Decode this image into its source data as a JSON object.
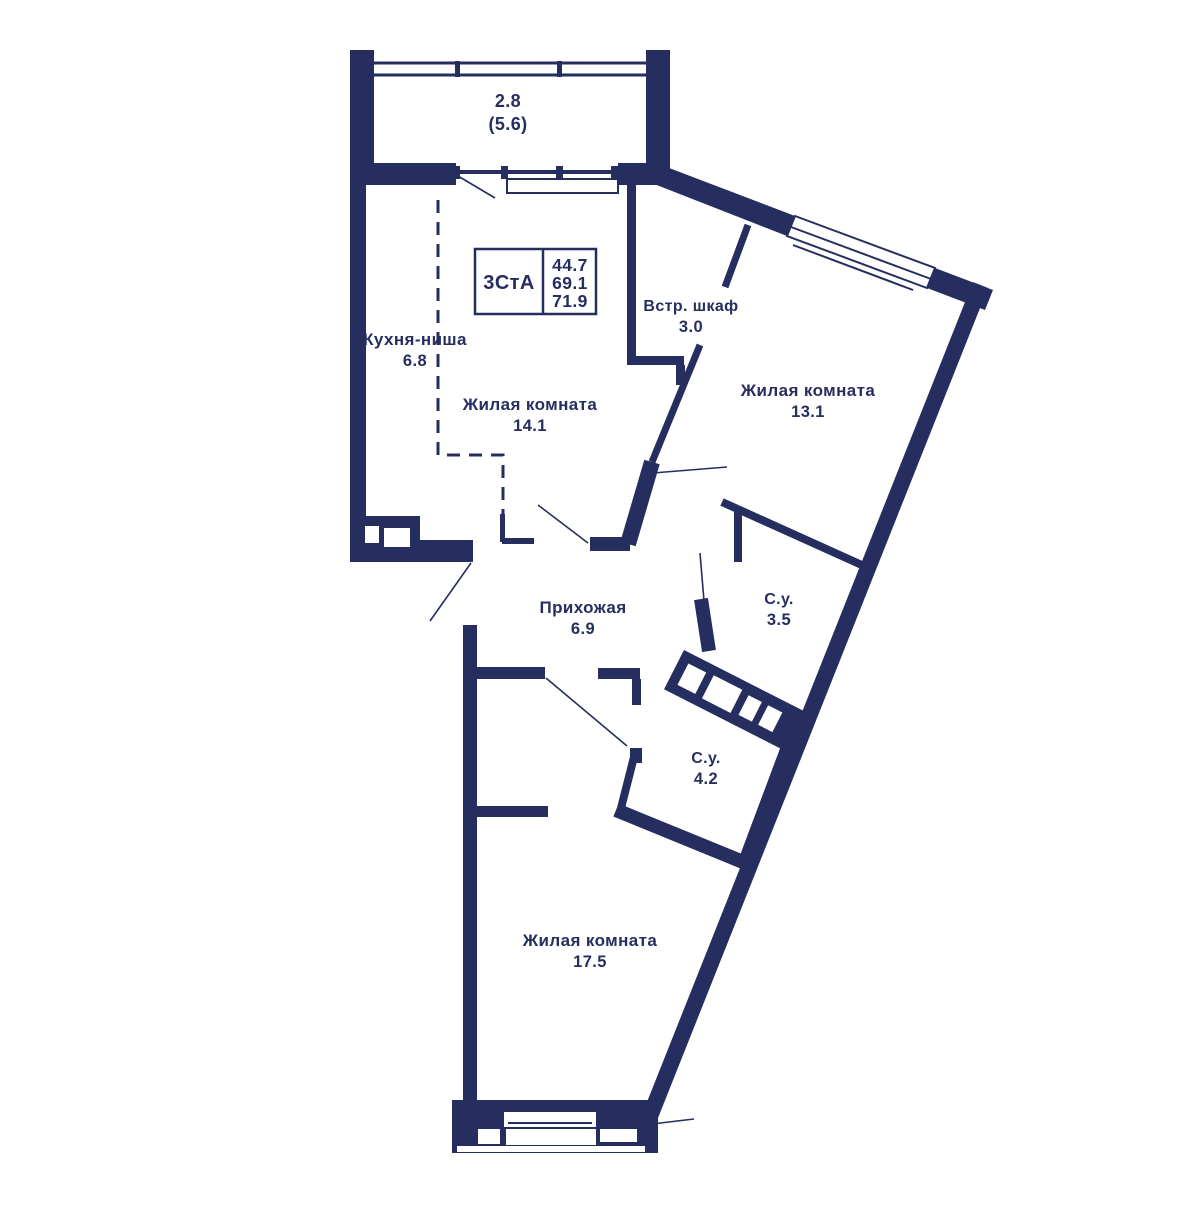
{
  "plan": {
    "stamp": {
      "type": "3СтА",
      "area_living": "44.7",
      "area_usable": "69.1",
      "area_total": "71.9"
    },
    "balcony": {
      "area": "2.8",
      "area_total": "(5.6)"
    },
    "rooms": [
      {
        "id": "kitchen-niche",
        "name": "Кухня-ниша",
        "area": "6.8"
      },
      {
        "id": "living-1",
        "name": "Жилая комната",
        "area": "14.1"
      },
      {
        "id": "wardrobe",
        "name": "Встр. шкаф",
        "area": "3.0"
      },
      {
        "id": "living-2",
        "name": "Жилая комната",
        "area": "13.1"
      },
      {
        "id": "hallway",
        "name": "Прихожая",
        "area": "6.9"
      },
      {
        "id": "bathroom-1",
        "name": "С.у.",
        "area": "3.5"
      },
      {
        "id": "bathroom-2",
        "name": "С.у.",
        "area": "4.2"
      },
      {
        "id": "living-3",
        "name": "Жилая комната",
        "area": "17.5"
      }
    ],
    "colors": {
      "wall": "#262e60",
      "background": "#ffffff"
    }
  }
}
